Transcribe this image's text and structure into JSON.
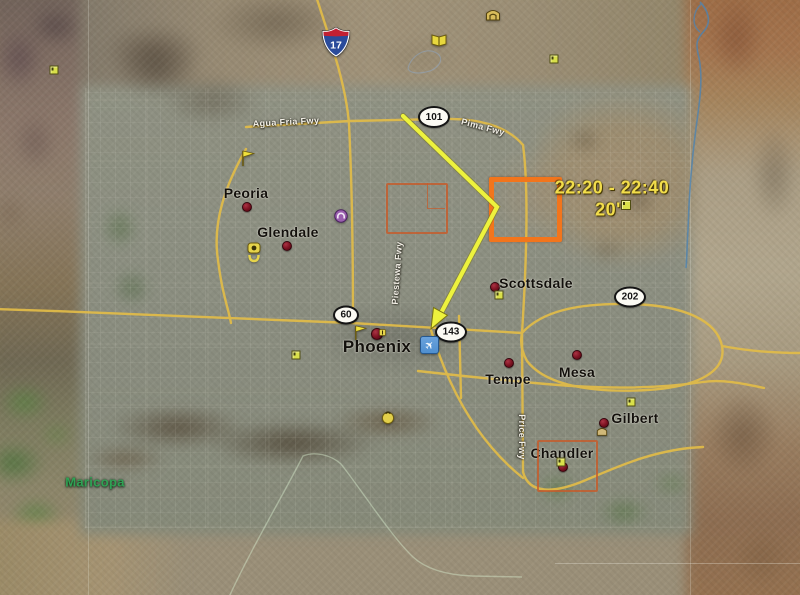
{
  "annotation": {
    "time_range": "22:20 - 22:40",
    "duration": "20'",
    "text_color": "#f2dd4b",
    "arrow_color": "#edf23d",
    "primary_box_color": "#f2751c",
    "secondary_box_color": "#c85a28"
  },
  "cities": [
    {
      "name": "Peoria"
    },
    {
      "name": "Glendale"
    },
    {
      "name": "Phoenix"
    },
    {
      "name": "Scottsdale"
    },
    {
      "name": "Tempe"
    },
    {
      "name": "Mesa"
    },
    {
      "name": "Gilbert"
    },
    {
      "name": "Chandler"
    },
    {
      "name": "Maricopa"
    }
  ],
  "shields": {
    "i17": {
      "number": "17"
    },
    "s101": {
      "number": "101"
    },
    "s60": {
      "number": "60"
    },
    "s143": {
      "number": "143"
    },
    "s202": {
      "number": "202"
    }
  },
  "road_labels": [
    {
      "text": "Agua Fria Fwy"
    },
    {
      "text": "Pima Fwy"
    },
    {
      "text": "Piestewa Fwy"
    },
    {
      "text": "Price Fwy"
    }
  ],
  "icons": {
    "airplane_glyph": "✈",
    "flag_color": "#efe13c",
    "placemark_color": "#d9e04a",
    "purple_poi_color": "#9a5fae",
    "book_color": "#e8d83e",
    "monument_color": "#d8bc5a",
    "airport_blue": "#5a95d5",
    "city_dot_color": "#7a1120"
  },
  "map_colors": {
    "road": "#e2bc48",
    "river": "#4d83b0"
  }
}
